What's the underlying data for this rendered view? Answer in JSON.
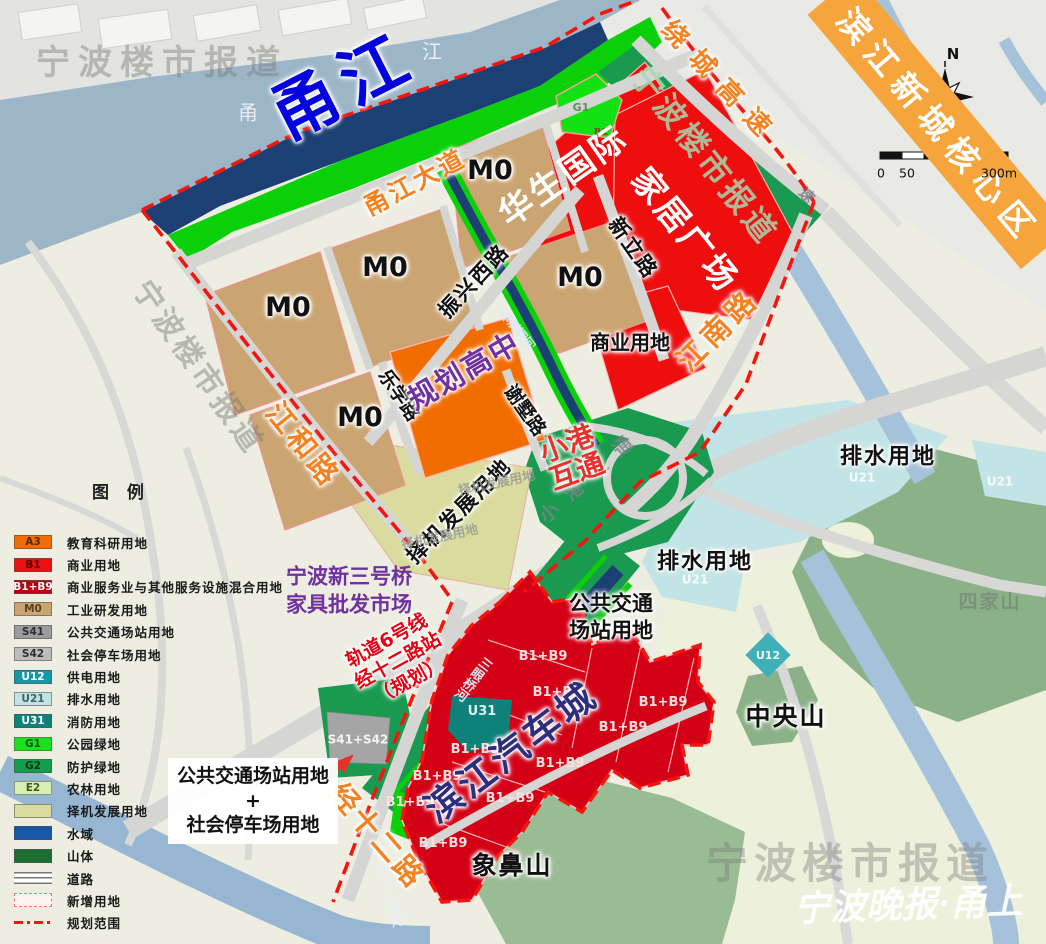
{
  "banner": {
    "text": "滨江新城核心区"
  },
  "compass": {
    "north": "N"
  },
  "scalebar": {
    "zero": "0",
    "fifty": "50",
    "max": "300m"
  },
  "watermark": {
    "brand": "宁波楼市报道",
    "signature": "宁波晚报·甬上"
  },
  "water": {
    "river_main": "甬江",
    "river_char_left": "甬",
    "river_char_right": "江",
    "canal_sanyanqiao": "三眼桥河",
    "canal_shiqiupu": "石湫浦河",
    "canal_jingshierlu": "经十二路河"
  },
  "roads": {
    "yongjiang_avenue": "甬江大道",
    "raocheng_expressway": "绕城高速",
    "jiangnan_road": "江南路",
    "zhenxing_west_road": "振兴西路",
    "xinli_road": "新立路",
    "lexue_road": "乐学路",
    "xieshu_road": "谢墅路",
    "jianghe_road": "江和路",
    "jingshier_road": "经十二路",
    "expwy_hint": "速"
  },
  "zones": {
    "m0": "M0",
    "b1b9": "B1+B9",
    "g1": "G1",
    "b1": "B1",
    "u31": "U31",
    "u12": "U12",
    "u21": "U21",
    "s41s42": "S41+S42"
  },
  "labels": {
    "huasheng": "华生国际",
    "jiaju": "家居广场",
    "shangye": "商业用地",
    "gaozhong": "规划高中",
    "xiaogang_1": "小港",
    "xiaogang_2": "互通",
    "xiaogang_base": "小港互通",
    "zeji": "择机发展用地",
    "paishui": "排水用地",
    "autocity": "滨江汽车城",
    "zhongyangshan": "中央山",
    "xiangbishan": "象鼻山",
    "sijiashan": "四家山",
    "transit_1": "公共交通",
    "transit_2": "场站用地",
    "market_1": "宁波新三号桥",
    "market_2": "家具批发市场",
    "rail_1": "轨道6号线",
    "rail_2": "经十二路站",
    "rail_3": "（规划）",
    "combo_1": "公共交通场站用地",
    "combo_plus": "+",
    "combo_2": "社会停车场用地"
  },
  "legend": {
    "title": "图    例",
    "items": [
      {
        "code": "A3",
        "label": "教育科研用地",
        "type": "fill",
        "color": "#f26d00",
        "code_color": "#5a2600"
      },
      {
        "code": "B1",
        "label": "商业用地",
        "type": "fill",
        "color": "#ee1010",
        "code_color": "#5a0000"
      },
      {
        "code": "B1+B9",
        "label": "商业服务业与其他服务设施混合用地",
        "type": "fill",
        "color": "#b80012",
        "code_color": "#ffffff"
      },
      {
        "code": "M0",
        "label": "工业研发用地",
        "type": "fill",
        "color": "#cba571",
        "code_color": "#584022"
      },
      {
        "code": "S41",
        "label": "公共交通场站用地",
        "type": "fill",
        "color": "#9c9c9c",
        "code_color": "#2e2e2e"
      },
      {
        "code": "S42",
        "label": "社会停车场用地",
        "type": "fill",
        "color": "#bdbdbd",
        "code_color": "#2e2e2e"
      },
      {
        "code": "U12",
        "label": "供电用地",
        "type": "fill",
        "color": "#1598a8",
        "code_color": "#ffffff"
      },
      {
        "code": "U21",
        "label": "排水用地",
        "type": "fill",
        "color": "#c2e2e4",
        "code_color": "#3f6568"
      },
      {
        "code": "U31",
        "label": "消防用地",
        "type": "fill",
        "color": "#0e8178",
        "code_color": "#ffffff"
      },
      {
        "code": "G1",
        "label": "公园绿地",
        "type": "fill",
        "color": "#1ee11e",
        "code_color": "#0a520a"
      },
      {
        "code": "G2",
        "label": "防护绿地",
        "type": "fill",
        "color": "#129e4d",
        "code_color": "#08330f"
      },
      {
        "code": "E2",
        "label": "农林用地",
        "type": "fill",
        "color": "#d8efb4",
        "code_color": "#3f5a1f"
      },
      {
        "code": "",
        "label": "择机发展用地",
        "type": "fill",
        "color": "#d9dc9e",
        "code_color": "#555555"
      },
      {
        "code": "",
        "label": "水域",
        "type": "fill",
        "color": "#1857a8",
        "code_color": "#ffffff"
      },
      {
        "code": "",
        "label": "山体",
        "type": "fill",
        "color": "#1f6e33",
        "code_color": "#ffffff"
      },
      {
        "code": "",
        "label": "道路",
        "type": "road",
        "color": "#ffffff",
        "code_color": "#555555"
      },
      {
        "code": "",
        "label": "新增用地",
        "type": "newland",
        "color": "#e87878",
        "code_color": "#555555"
      },
      {
        "code": "",
        "label": "规划范围",
        "type": "boundary",
        "color": "#f6150d",
        "code_color": "#555555"
      }
    ]
  }
}
